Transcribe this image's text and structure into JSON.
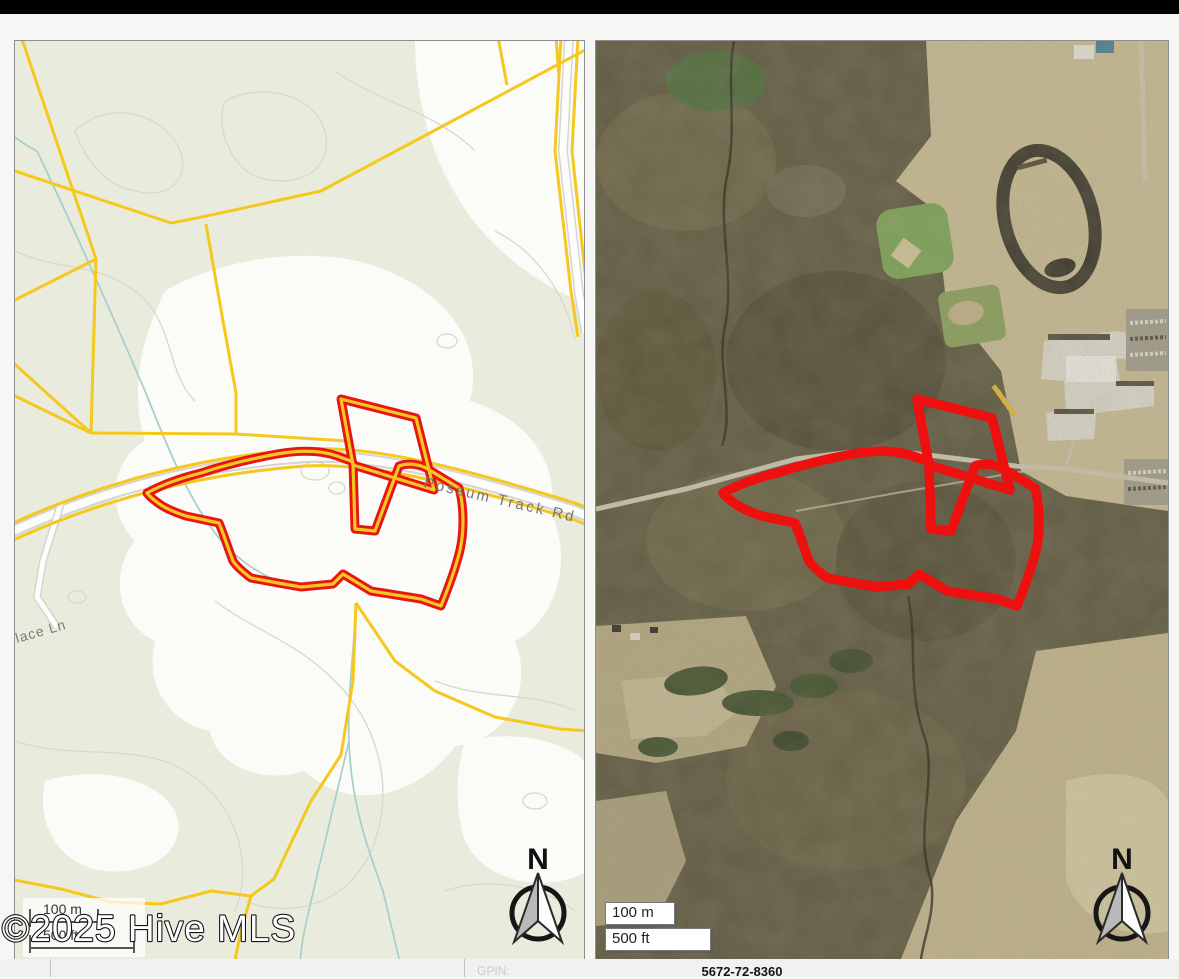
{
  "page": {
    "top_bar_color": "#000000",
    "background": "#f6f6f5"
  },
  "watermark": "©2025 Hive MLS",
  "left_map": {
    "kind": "parcel and topographic map",
    "road_label": "Possum Track Rd",
    "partial_road_label": "lace Ln",
    "north_label": "N",
    "scalebar": {
      "metric": "100 m",
      "imperial": "500 ft"
    },
    "colors": {
      "background": "#e9ecdc",
      "parcel_line": "#f4c81e",
      "boundary": "#e91414",
      "stream": "#a5cecb",
      "contour": "#d8d8cd",
      "road": "#ffffff"
    }
  },
  "right_map": {
    "kind": "aerial imagery map",
    "north_label": "N",
    "scalebar": {
      "metric": "100 m",
      "imperial": "500 ft"
    },
    "colors": {
      "boundary": "#ee0f0f",
      "forest": "#5f5942",
      "field": "#c9bc96"
    }
  },
  "footer": {
    "gpin_label": "GPIN:",
    "gpin_value": "5672-72-8360"
  }
}
